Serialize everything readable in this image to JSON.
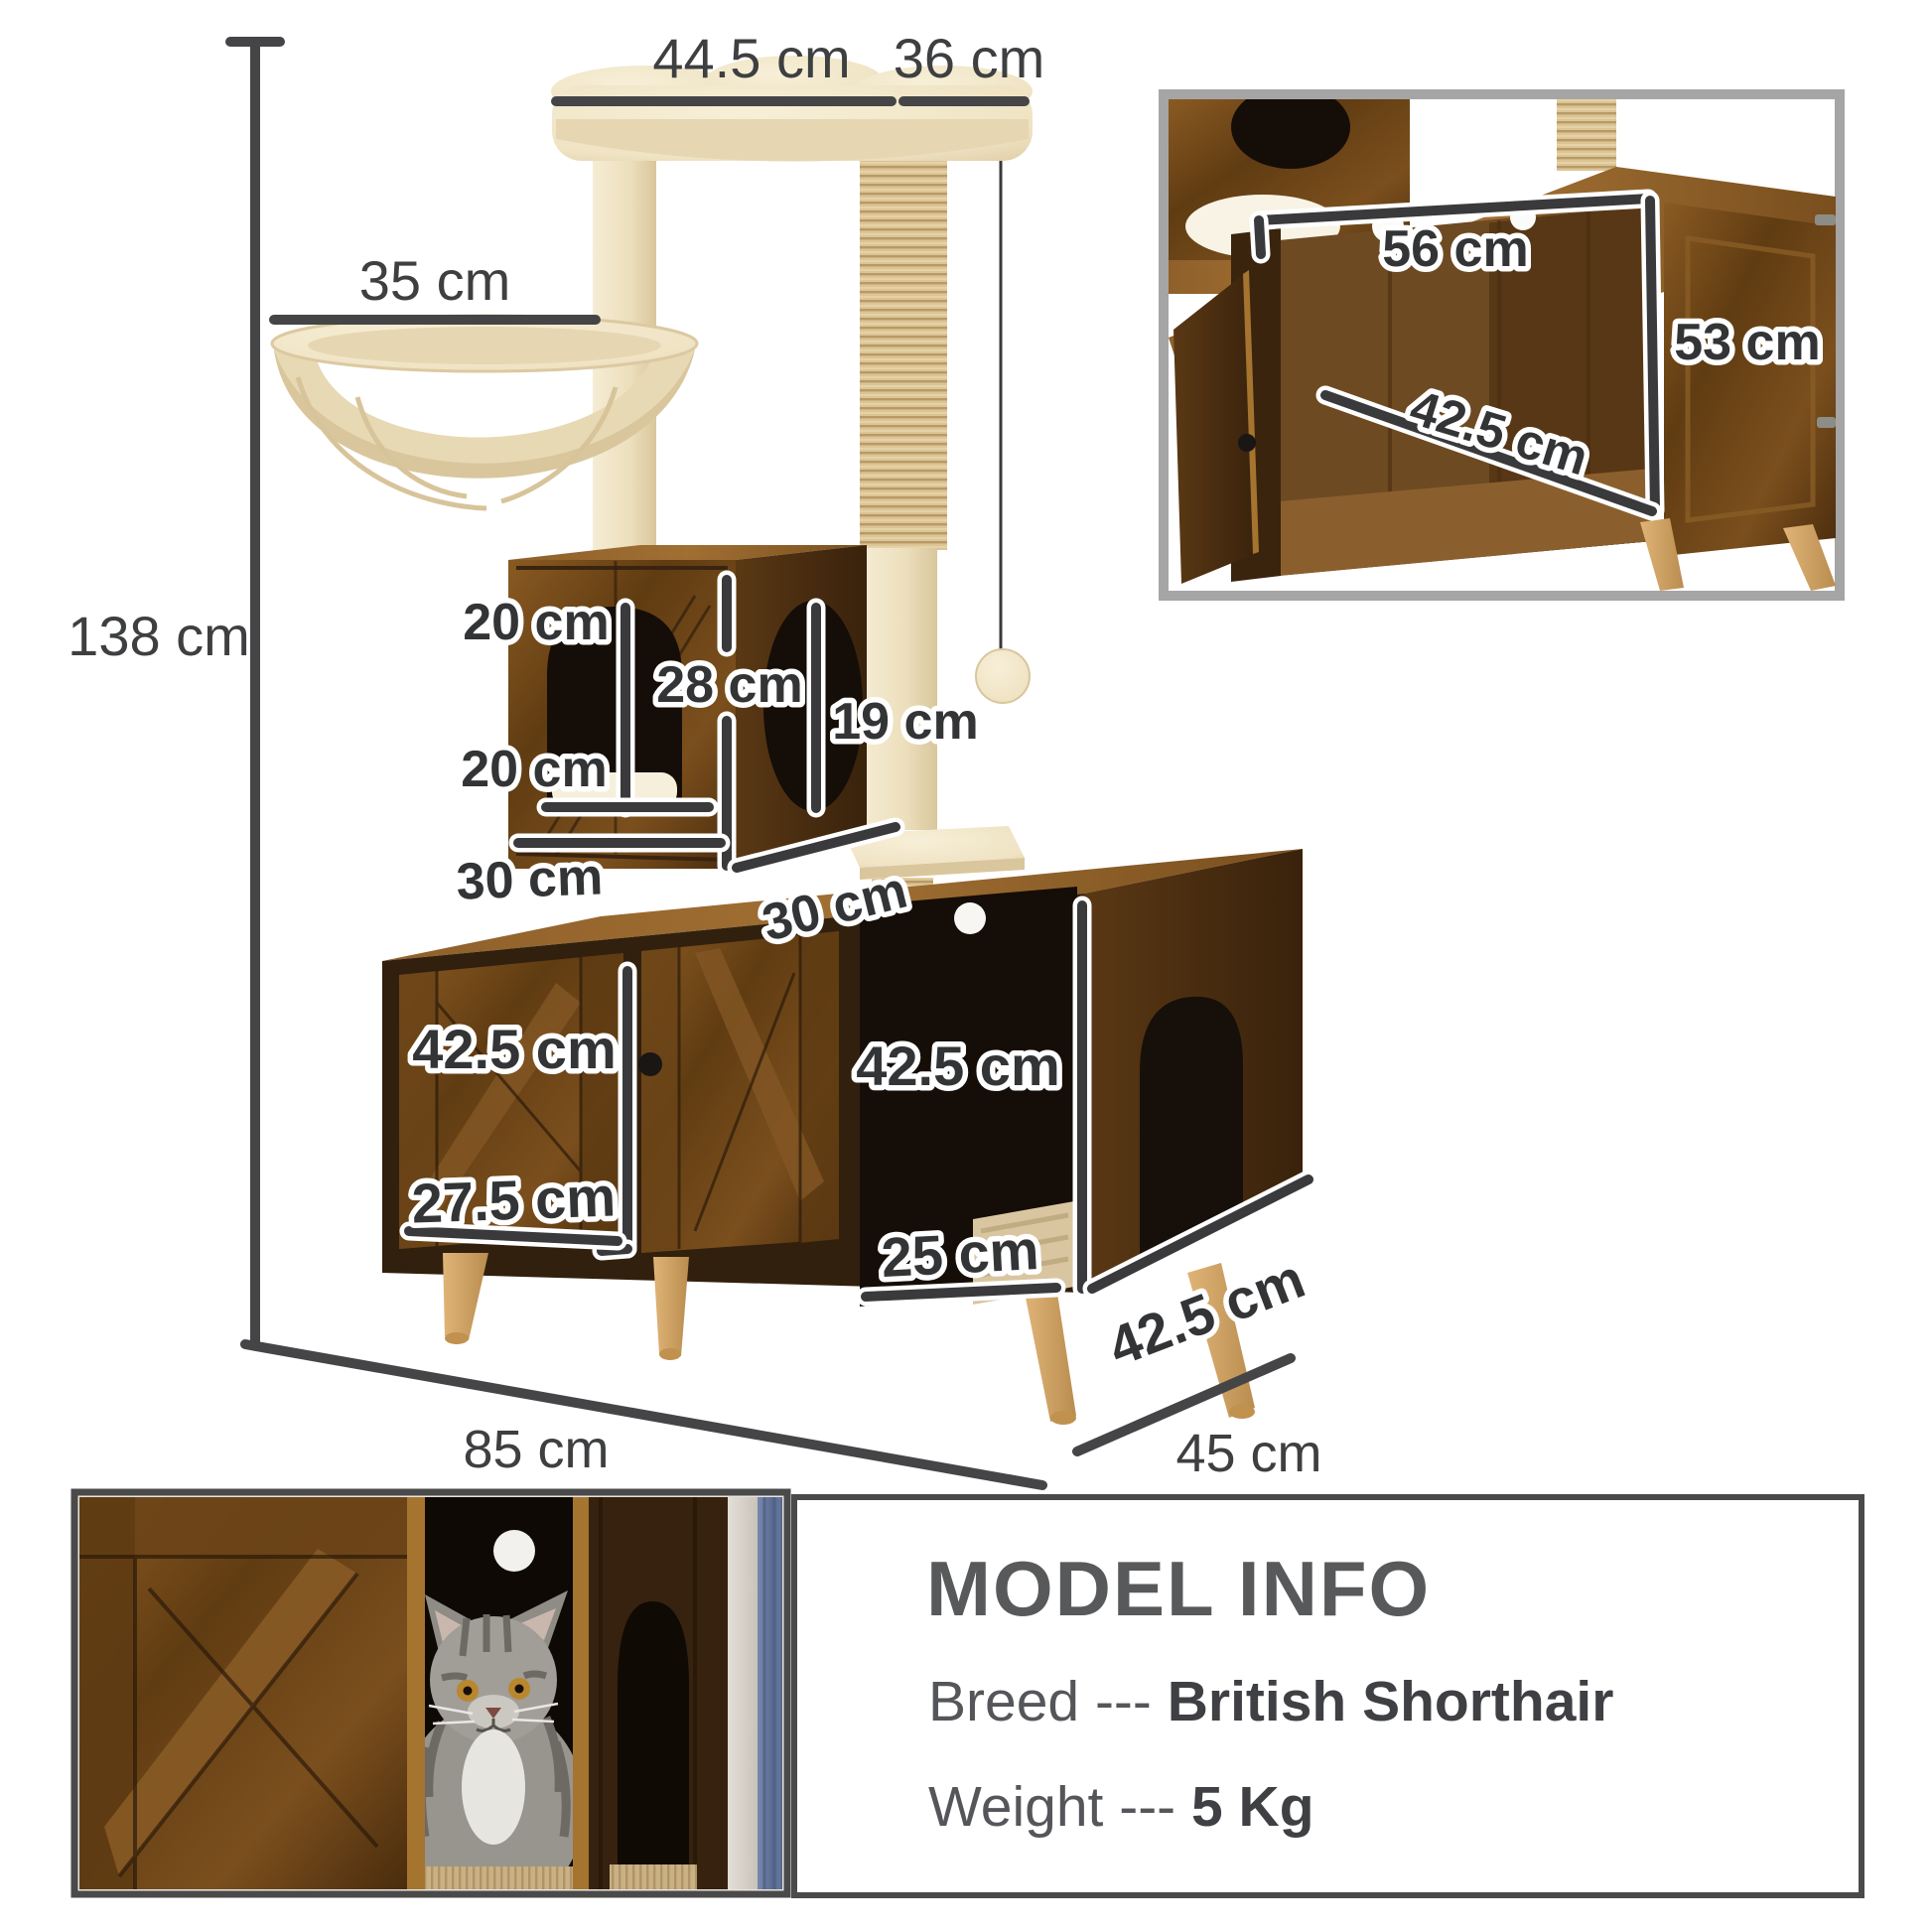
{
  "figure": {
    "total_height": "138 cm",
    "top_width": "44.5 cm",
    "top_depth": "36 cm",
    "hammock_width": "35 cm",
    "condo_hole_height": "20 cm",
    "condo_inner_height": "28 cm",
    "condo_hole_width": "20 cm",
    "condo_side_hole": "19 cm",
    "condo_width": "30 cm",
    "condo_depth": "30 cm",
    "door_height": "42.5 cm",
    "door_width": "27.5 cm",
    "opening_height": "42.5 cm",
    "opening_width": "25 cm",
    "base_side_depth": "42.5 cm",
    "base_width": "85 cm",
    "base_depth": "45 cm"
  },
  "inset": {
    "inner_width": "56 cm",
    "inner_height": "53 cm",
    "inner_depth": "42.5 cm"
  },
  "info": {
    "title": "MODEL INFO",
    "breed_label": "Breed ---",
    "breed_value": "British Shorthair",
    "weight_label": "Weight ---",
    "weight_value": "5 Kg"
  }
}
